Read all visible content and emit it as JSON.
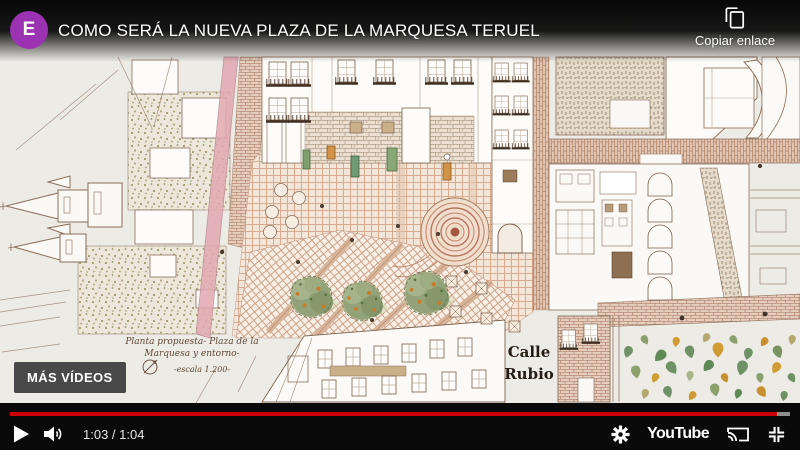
{
  "overlay": {
    "title": "COMO SERÁ LA NUEVA PLAZA DE LA MARQUESA TERUEL",
    "channel_initial": "E",
    "copy_link_label": "Copiar enlace",
    "more_videos_label": "MÁS VÍDEOS"
  },
  "player": {
    "current_time": "1:03",
    "time_separator": " / ",
    "duration": "1:04",
    "progress_percent": 98.3,
    "logo_text": "YouTube",
    "colors": {
      "progress": "#cc0000",
      "avatar": "#9b32b2"
    }
  },
  "plan": {
    "label_line1": "Planta propuesta- Plaza de la",
    "label_line2": "Marquesa y entorno-",
    "scale_label": "-escala 1.200-",
    "street_name_line1": "Calle",
    "street_name_line2": "Rubio"
  }
}
